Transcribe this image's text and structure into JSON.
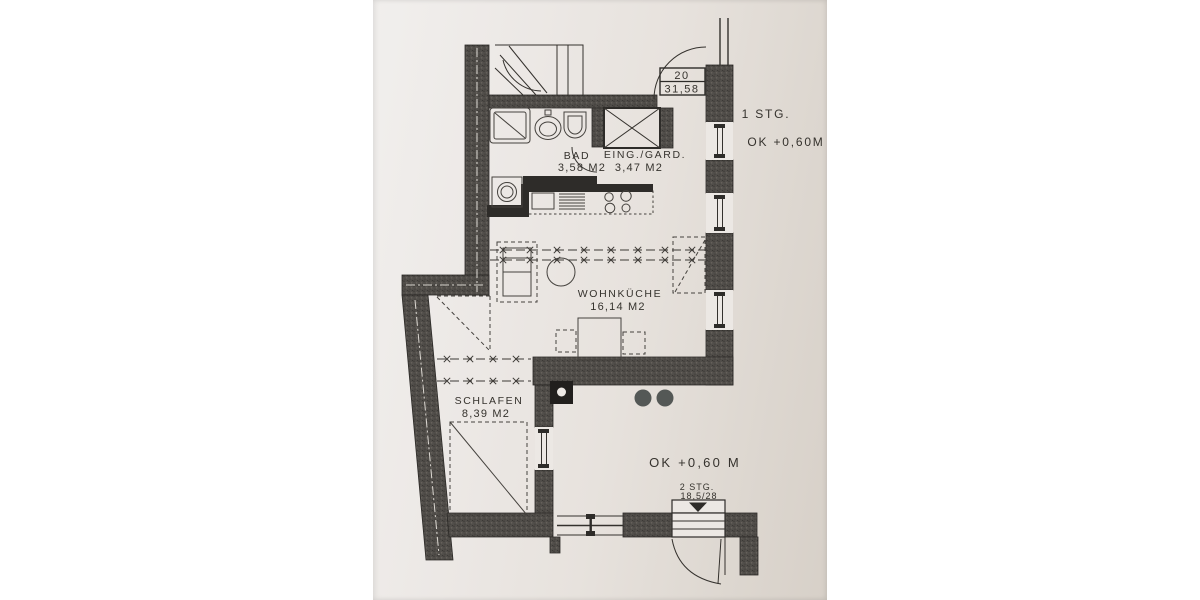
{
  "photo": {
    "description": "photographed black-and-white floor plan on paper",
    "paper_color": "#e9e5e1",
    "ink_color": "#2e2c29",
    "wall_color": "#4e4b47",
    "page_background": "#ffffff"
  },
  "plan": {
    "unit_label": {
      "number": "20",
      "area": "31,58"
    },
    "rooms": {
      "bad": {
        "name": "BAD",
        "area": "3,58 M2"
      },
      "eingang": {
        "name": "EING./GARD.",
        "area": "3,47 M2"
      },
      "wohnkueche": {
        "name": "WOHNKÜCHE",
        "area": "16,14 M2"
      },
      "schlafen": {
        "name": "SCHLAFEN",
        "area": "8,39 M2"
      }
    },
    "notes": {
      "floor": "1 STG.",
      "level_upper": "OK +0,60M",
      "level_lower": "OK +0,60 M",
      "stairs2_line1": "2 STG.",
      "stairs2_line2": "18,5/28"
    }
  }
}
